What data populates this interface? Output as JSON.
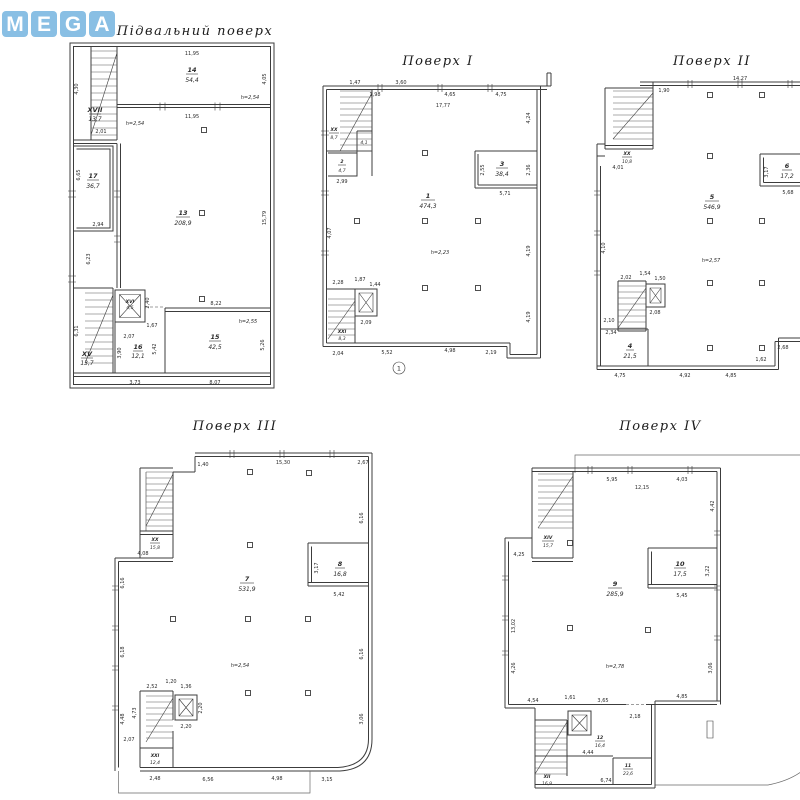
{
  "watermark": {
    "text": "MEGA",
    "letters": [
      "M",
      "E",
      "G",
      "A"
    ],
    "color": "#7db9e2"
  },
  "plans": [
    {
      "title": "Підвальний поверх",
      "rooms": {
        "r14": {
          "num": "14",
          "area": "54,4"
        },
        "r17": {
          "num": "17",
          "area": "36,7"
        },
        "r13": {
          "num": "13",
          "area": "208,9"
        },
        "r15": {
          "num": "15",
          "area": "42,5"
        },
        "r16": {
          "num": "16",
          "area": "12,1"
        },
        "s17": {
          "num": "XVII",
          "area": "13,7"
        },
        "lift": {
          "num": "XVI",
          "area": "4,5"
        },
        "s15": {
          "num": "XV",
          "area": "13,7"
        }
      },
      "notes": {
        "h14": "h=2,54",
        "h13": "h=2,54",
        "h15": "h=2,55"
      },
      "dims": {
        "top1195": "11,95",
        "r405": "4,05",
        "l430": "4,30",
        "w201": "2,01",
        "mid1195": "11,95",
        "l665": "6,65",
        "w294": "2,94",
        "l623": "6,23",
        "r1579": "15,79",
        "e240": "2,40",
        "e167": "1,67",
        "e207": "2,07",
        "l390": "3,90",
        "m542": "5,42",
        "t822": "8,22",
        "l631": "6,31",
        "b373": "3,73",
        "b807": "8,07",
        "r526": "5,26"
      }
    },
    {
      "title": "Поверх I",
      "rooms": {
        "hall": {
          "num": "1",
          "area": "474,3"
        },
        "r3": {
          "num": "3",
          "area": "38,4"
        },
        "stair": {
          "num": "XX",
          "area": "8,7"
        },
        "lobby": {
          "area": "4,1"
        },
        "vest": {
          "num": "2",
          "area": "4,7"
        },
        "bstair": {
          "num": "XXI",
          "area": "8,3"
        }
      },
      "notes": {
        "h": "h=2,23"
      },
      "axis": {
        "a1": "1"
      },
      "dims": {
        "t147": "1,47",
        "t198": "1,98",
        "t360": "3,60",
        "t465": "4,65",
        "t475": "4,75",
        "t1777": "17,77",
        "r424": "4,24",
        "r419a": "4,19",
        "r419b": "4,19",
        "l407": "4,07",
        "v299": "2,99",
        "e228": "2,28",
        "e187": "1,87",
        "e144": "1,44",
        "e209": "2,09",
        "b204": "2,04",
        "b552": "5,52",
        "b498": "4,98",
        "b219": "2,19",
        "r571": "5,71",
        "r255": "2,55",
        "r236": "2,36"
      }
    },
    {
      "title": "Поверх II",
      "rooms": {
        "hall": {
          "num": "5",
          "area": "546,9"
        },
        "r6": {
          "num": "6",
          "area": "17,2"
        },
        "r4": {
          "num": "4",
          "area": "21,5"
        },
        "stair": {
          "num": "XX",
          "area": "10,8"
        }
      },
      "notes": {
        "h": "h=2,57"
      },
      "dims": {
        "t1427": "14,27",
        "t190": "1,90",
        "t182": "1,82",
        "r455": "4,55",
        "r491": "4,91",
        "r470": "4,70",
        "l401": "4,01",
        "l410": "4,10",
        "l210": "2,10",
        "l234": "2,34",
        "e202": "2,02",
        "e154": "1,54",
        "e150": "1,50",
        "e208": "2,08",
        "b475": "4,75",
        "b492": "4,92",
        "b485": "4,85",
        "b268": "2,68",
        "b162": "1,62",
        "r568": "5,68",
        "r317": "3,17"
      }
    },
    {
      "title": "Поверх III",
      "rooms": {
        "hall": {
          "num": "7",
          "area": "531,9"
        },
        "r8": {
          "num": "8",
          "area": "16,8"
        },
        "lobby": {
          "num": "XX",
          "area": "15,8"
        },
        "bstair": {
          "num": "XXI",
          "area": "12,4"
        }
      },
      "notes": {
        "h": "h=2,54"
      },
      "dims": {
        "t140": "1,40",
        "t1530": "15,30",
        "t267": "2,67",
        "r616a": "6,16",
        "r616b": "6,16",
        "r306": "3,06",
        "l616": "6,16",
        "l618": "6,18",
        "l448": "4,48",
        "l207": "2,07",
        "l473": "4,73",
        "w408": "4,08",
        "e252": "2,52",
        "e120": "1,20",
        "e136": "1,36",
        "e220a": "2,20",
        "e220b": "2,20",
        "b248": "2,48",
        "b656": "6,56",
        "b498": "4,98",
        "b315": "3,15",
        "r542": "5,42",
        "r317": "3,17"
      }
    },
    {
      "title": "Поверх IV",
      "rooms": {
        "hall": {
          "num": "9",
          "area": "285,9"
        },
        "r10": {
          "num": "10",
          "area": "17,5"
        },
        "lobby": {
          "num": "XIV",
          "area": "15,7"
        },
        "r12": {
          "num": "12",
          "area": "16,4"
        },
        "r11": {
          "num": "11",
          "area": "23,6"
        },
        "bstair": {
          "num": "XII",
          "area": "16,9"
        }
      },
      "notes": {
        "h": "h=2,78"
      },
      "dims": {
        "t595": "5,95",
        "t1215": "12,15",
        "t403": "4,03",
        "r442": "4,42",
        "l425": "4,25",
        "l1302": "13,02",
        "l426": "4,26",
        "r306": "3,06",
        "r545": "5,45",
        "r322": "3,22",
        "b454": "4,54",
        "b161": "1,61",
        "b365": "3,65",
        "b218": "2,18",
        "b485": "4,85",
        "b444": "4,44",
        "b674": "6,74"
      }
    }
  ]
}
